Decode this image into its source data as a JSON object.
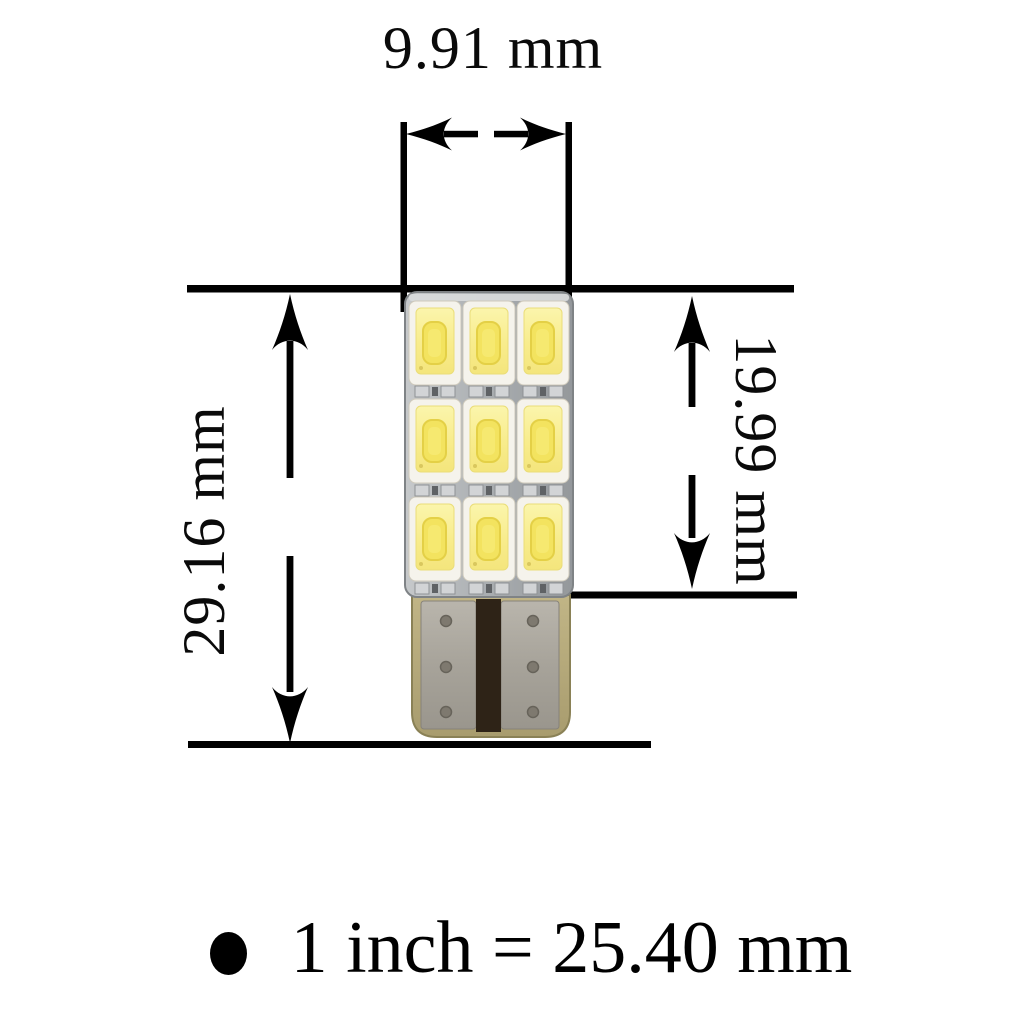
{
  "diagram": {
    "dimensions": {
      "width": "9.91 mm",
      "total_height": "29.16 mm",
      "led_section_height": "19.99 mm"
    },
    "scale_note": "1 inch = 25.40 mm",
    "illustration": {
      "subject": "T10 wedge LED bulb with 3x3 SMD LED grid",
      "led_rows": 3,
      "led_columns": 3
    },
    "colors": {
      "line": "#000000",
      "background": "#ffffff",
      "pcb_gray": "#aab0b4",
      "led_body_white": "#f5f3ec",
      "led_phosphor_yellow": "#f8ed8d",
      "led_die_yellow": "#f1e05b",
      "base_plastic_olive": "#b2a778",
      "base_metal_gray": "#a9a59c",
      "base_contact_stripe": "#2e2317"
    }
  }
}
